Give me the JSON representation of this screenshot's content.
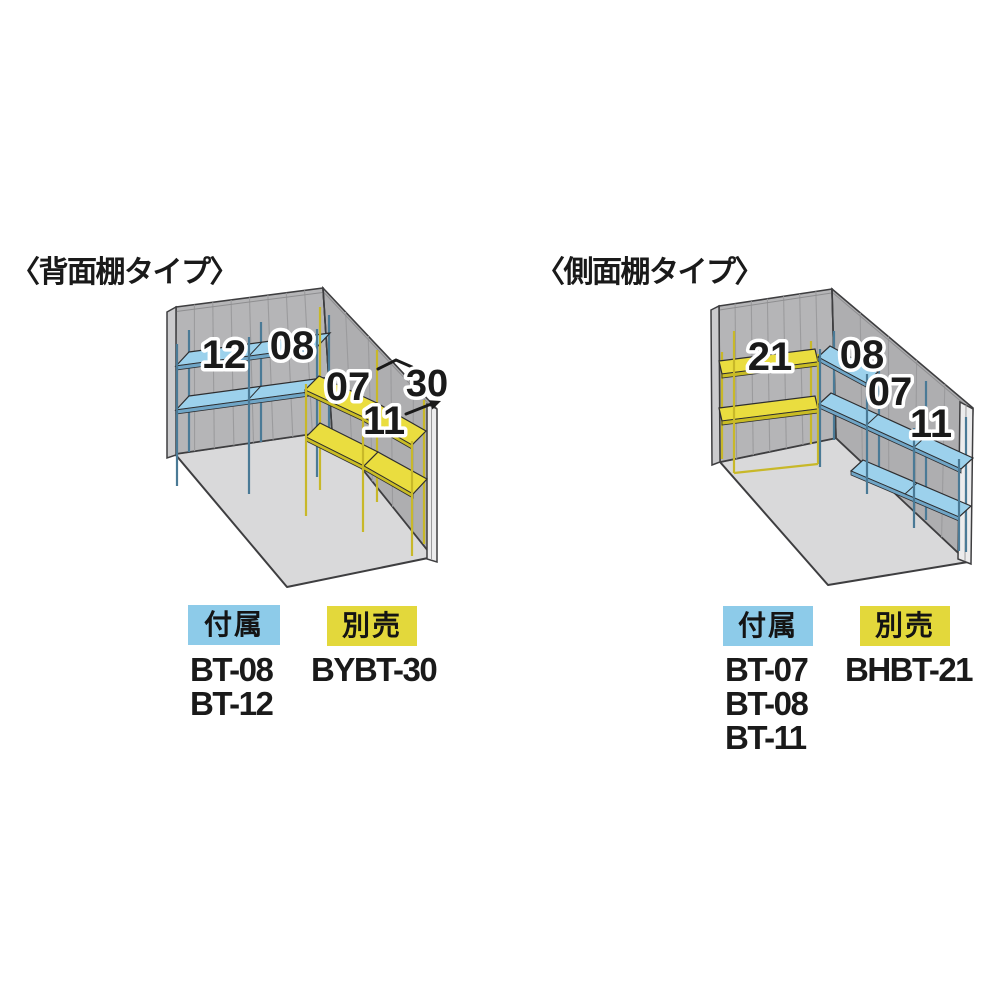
{
  "page": {
    "background": "#ffffff"
  },
  "colors": {
    "included_badge_bg": "#8DCBE9",
    "separate_badge_bg": "#E3D83B",
    "blue_shelf": "#9CD1EC",
    "yellow_shelf": "#EADD3F",
    "wall": "#B5B5B7",
    "floor": "#D9D9DA"
  },
  "diagrams": [
    {
      "id": "back-shelf-type",
      "title": "〈背面棚タイプ〉",
      "labels": {
        "l12": "12",
        "l08": "08",
        "l07": "07",
        "l11": "11",
        "l30": "30"
      },
      "legend": {
        "included_label": "付属",
        "included_codes": [
          "BT-08",
          "BT-12"
        ],
        "separate_label": "別売",
        "separate_codes": [
          "BYBT-30"
        ]
      }
    },
    {
      "id": "side-shelf-type",
      "title": "〈側面棚タイプ〉",
      "labels": {
        "l21": "21",
        "l08": "08",
        "l07": "07",
        "l11": "11"
      },
      "legend": {
        "included_label": "付属",
        "included_codes": [
          "BT-07",
          "BT-08",
          "BT-11"
        ],
        "separate_label": "別売",
        "separate_codes": [
          "BHBT-21"
        ]
      }
    }
  ]
}
